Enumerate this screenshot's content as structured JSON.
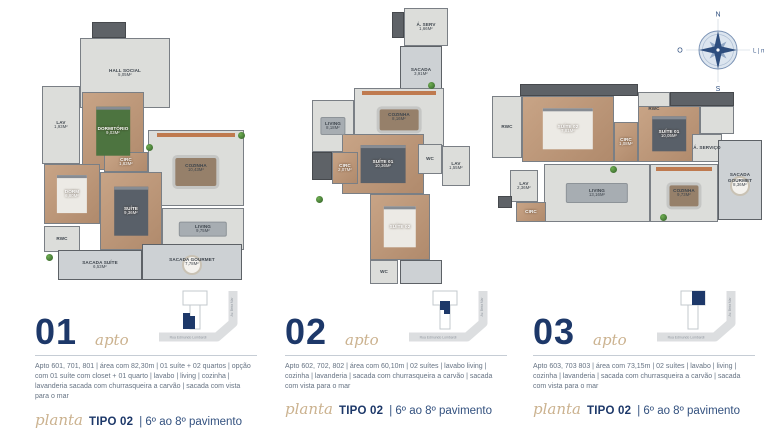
{
  "colors": {
    "navy": "#1d3869",
    "script_tan": "#cbb28f",
    "body_text": "#667383"
  },
  "compass": {
    "north": "N",
    "south": "S",
    "west": "O",
    "east": "L | mar"
  },
  "plans": [
    {
      "container": "floorplan-01",
      "rooms": [
        {
          "label": "",
          "x": 50,
          "y": 10,
          "w": 34,
          "h": 16,
          "t": "dark"
        },
        {
          "label": "HALL SOCIAL",
          "area": "5,05m²",
          "x": 38,
          "y": 26,
          "w": 90,
          "h": 70,
          "t": "tile"
        },
        {
          "label": "LAV",
          "area": "1,93m²",
          "x": 0,
          "y": 74,
          "w": 38,
          "h": 78,
          "t": "tile"
        },
        {
          "label": "DORMITÓRIO",
          "area": "9,03m²",
          "x": 40,
          "y": 80,
          "w": 62,
          "h": 78,
          "t": "wood",
          "f": "bed-green"
        },
        {
          "label": "COZINHA",
          "area": "10,43m²",
          "x": 106,
          "y": 118,
          "w": 96,
          "h": 76,
          "t": "tile",
          "f": "dining"
        },
        {
          "label": "CIRC",
          "area": "1,83m²",
          "x": 62,
          "y": 140,
          "w": 44,
          "h": 20,
          "t": "wood"
        },
        {
          "label": "DORM",
          "area": "6,80m²",
          "x": 2,
          "y": 152,
          "w": 56,
          "h": 60,
          "t": "wood",
          "f": "bed"
        },
        {
          "label": "RWC",
          "area": "",
          "x": 2,
          "y": 214,
          "w": 36,
          "h": 26,
          "t": "tile"
        },
        {
          "label": "SUÍTE",
          "area": "9,36m²",
          "x": 58,
          "y": 160,
          "w": 62,
          "h": 78,
          "t": "wood",
          "f": "bed-dark"
        },
        {
          "label": "LIVING",
          "area": "9,75m²",
          "x": 120,
          "y": 196,
          "w": 82,
          "h": 42,
          "t": "tile",
          "f": "sofa"
        },
        {
          "label": "SACADA SUÍTE",
          "area": "6,53m²",
          "x": 16,
          "y": 238,
          "w": 84,
          "h": 30,
          "t": "balcony"
        },
        {
          "label": "SACADA GOURMET",
          "area": "7,78m²",
          "x": 100,
          "y": 232,
          "w": 100,
          "h": 36,
          "t": "balcony",
          "f": "round-table"
        }
      ],
      "plants": [
        [
          104,
          132
        ],
        [
          4,
          242
        ],
        [
          196,
          120
        ]
      ]
    },
    {
      "container": "floorplan-02",
      "rooms": [
        {
          "label": "",
          "x": 80,
          "y": 4,
          "w": 12,
          "h": 26,
          "t": "dark"
        },
        {
          "label": "Á. SERV",
          "area": "1,66m²",
          "x": 92,
          "y": 0,
          "w": 44,
          "h": 38,
          "t": "tile"
        },
        {
          "label": "SACADA",
          "area": "3,91m²",
          "x": 88,
          "y": 38,
          "w": 42,
          "h": 52,
          "t": "balcony"
        },
        {
          "label": "COZINHA",
          "area": "8,16m²",
          "x": 42,
          "y": 80,
          "w": 90,
          "h": 58,
          "t": "tile",
          "f": "dining"
        },
        {
          "label": "LIVING",
          "area": "8,18m²",
          "x": 0,
          "y": 92,
          "w": 42,
          "h": 52,
          "t": "tile",
          "f": "sofa"
        },
        {
          "label": "",
          "x": 0,
          "y": 144,
          "w": 20,
          "h": 28,
          "t": "dark"
        },
        {
          "label": "SUÍTE 01",
          "area": "10,36m²",
          "x": 30,
          "y": 126,
          "w": 82,
          "h": 60,
          "t": "wood",
          "f": "bed-dark"
        },
        {
          "label": "CIRC",
          "area": "2,07m²",
          "x": 20,
          "y": 144,
          "w": 26,
          "h": 32,
          "t": "wood"
        },
        {
          "label": "WC",
          "area": "",
          "x": 106,
          "y": 136,
          "w": 24,
          "h": 30,
          "t": "tile"
        },
        {
          "label": "LAV",
          "area": "1,55m²",
          "x": 130,
          "y": 138,
          "w": 28,
          "h": 40,
          "t": "tile"
        },
        {
          "label": "SUÍTE 02",
          "area": "",
          "x": 58,
          "y": 186,
          "w": 60,
          "h": 66,
          "t": "wood",
          "f": "bed"
        },
        {
          "label": "WC",
          "area": "",
          "x": 58,
          "y": 252,
          "w": 28,
          "h": 24,
          "t": "tile"
        },
        {
          "label": "",
          "x": 88,
          "y": 252,
          "w": 42,
          "h": 24,
          "t": "balcony"
        }
      ],
      "plants": [
        [
          116,
          74
        ],
        [
          4,
          188
        ]
      ]
    },
    {
      "container": "floorplan-03",
      "rooms": [
        {
          "label": "",
          "x": 28,
          "y": 0,
          "w": 118,
          "h": 12,
          "t": "dark"
        },
        {
          "label": "RWC",
          "area": "",
          "x": 0,
          "y": 12,
          "w": 30,
          "h": 62,
          "t": "tile"
        },
        {
          "label": "SUÍTE 02",
          "area": "7,81m²",
          "x": 30,
          "y": 12,
          "w": 92,
          "h": 66,
          "t": "wood",
          "f": "bed"
        },
        {
          "label": "CIRC",
          "area": "1,08m²",
          "x": 122,
          "y": 38,
          "w": 24,
          "h": 40,
          "t": "wood"
        },
        {
          "label": "RWC",
          "area": "",
          "x": 146,
          "y": 8,
          "w": 32,
          "h": 34,
          "t": "tile"
        },
        {
          "label": "",
          "x": 178,
          "y": 8,
          "w": 64,
          "h": 14,
          "t": "dark"
        },
        {
          "label": "SUÍTE 01",
          "area": "10,05m²",
          "x": 146,
          "y": 22,
          "w": 62,
          "h": 56,
          "t": "wood",
          "f": "bed-dark"
        },
        {
          "label": "",
          "x": 208,
          "y": 22,
          "w": 34,
          "h": 28,
          "t": "tile"
        },
        {
          "label": "Á. SERVIÇO",
          "area": "",
          "x": 200,
          "y": 50,
          "w": 30,
          "h": 28,
          "t": "tile"
        },
        {
          "label": "SACADA GOURMET",
          "area": "8,36m²",
          "x": 226,
          "y": 56,
          "w": 44,
          "h": 80,
          "t": "balcony",
          "f": "round-table"
        },
        {
          "label": "COZINHA",
          "area": "9,73m²",
          "x": 158,
          "y": 80,
          "w": 68,
          "h": 58,
          "t": "tile",
          "f": "dining"
        },
        {
          "label": "LIVING",
          "area": "13,16m²",
          "x": 52,
          "y": 80,
          "w": 106,
          "h": 58,
          "t": "tile",
          "f": "sofa"
        },
        {
          "label": "LAV",
          "area": "2,36m²",
          "x": 18,
          "y": 86,
          "w": 28,
          "h": 32,
          "t": "tile"
        },
        {
          "label": "CIRC",
          "area": "",
          "x": 24,
          "y": 118,
          "w": 30,
          "h": 20,
          "t": "wood"
        },
        {
          "label": "",
          "x": 6,
          "y": 112,
          "w": 14,
          "h": 12,
          "t": "dark"
        }
      ],
      "plants": [
        [
          118,
          82
        ],
        [
          168,
          130
        ]
      ]
    }
  ],
  "units": [
    {
      "number": "01",
      "script_label": "apto",
      "description": "Apto 601, 701, 801 | área com 82,30m | 01 suíte + 02 quartos | opção com 01 suíte com closet + 01 quarto | lavabo | living | cozinha | lavanderia sacada com churrasqueira a carvão | sacada com vista para o mar",
      "map": {
        "street_bottom": "Rua Edmundo Lombardi",
        "street_right": "Av. Beira Mar"
      },
      "planta_script": "planta",
      "tipo_label": "TIPO 02",
      "pavimento_label": "| 6º ao 8º pavimento"
    },
    {
      "number": "02",
      "script_label": "apto",
      "description": "Apto 602, 702, 802 | área com 60,10m | 02 suítes | lavabo living | cozinha | lavanderia | sacada com churrasqueira a carvão | sacada com vista para o mar",
      "map": {
        "street_bottom": "Rua Edmundo Lombardi",
        "street_right": "Av. Beira Mar"
      },
      "planta_script": "planta",
      "tipo_label": "TIPO 02",
      "pavimento_label": "| 6º ao 8º pavimento"
    },
    {
      "number": "03",
      "script_label": "apto",
      "description": "Apto 603, 703 803 | área com 73,15m | 02 suítes | lavabo | living | cozinha | lavanderia | sacada com churrasqueira a carvão | sacada com vista para o mar",
      "map": {
        "street_bottom": "Rua Edmundo Lombardi",
        "street_right": "Av. Beira Mar"
      },
      "planta_script": "planta",
      "tipo_label": "TIPO 02",
      "pavimento_label": "| 6º ao 8º pavimento"
    }
  ]
}
